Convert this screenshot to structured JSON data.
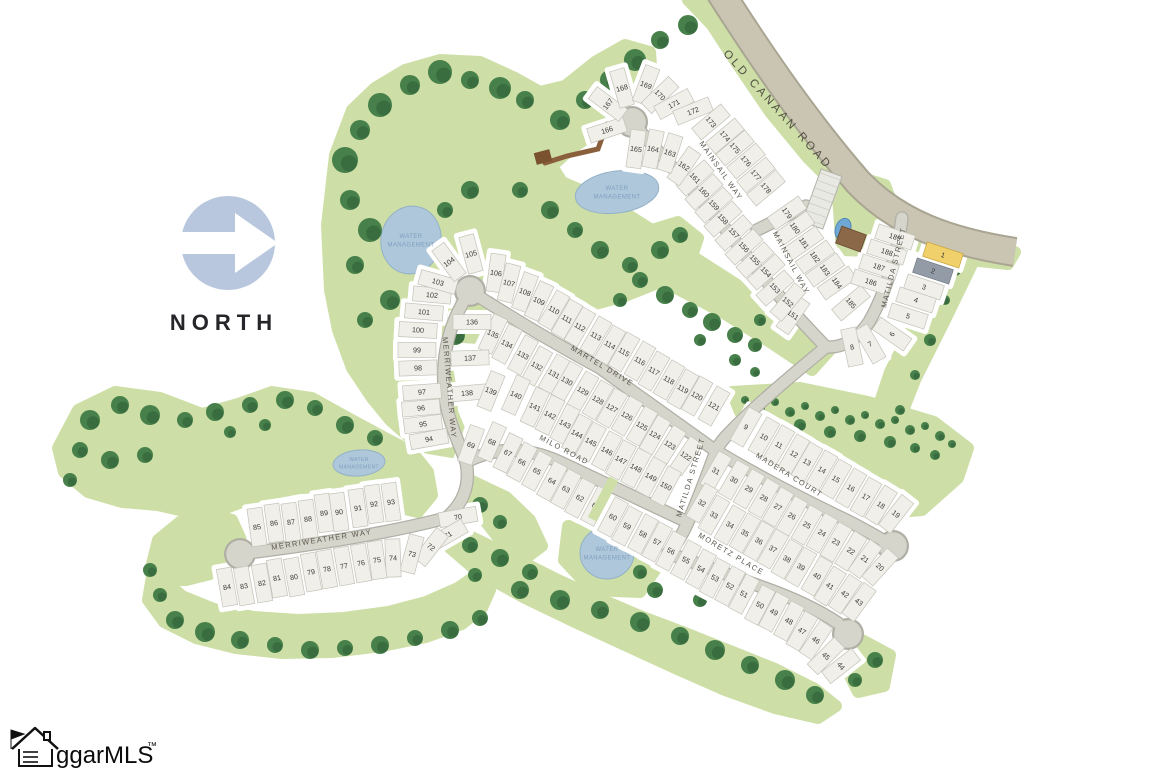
{
  "map": {
    "north_label": "NORTH",
    "logo": {
      "text": "ggarMLS",
      "tm": "™"
    },
    "water_label": [
      "WATER",
      "MANAGEMENT"
    ],
    "colors": {
      "green": "#cddfa6",
      "tree": "#47804a",
      "tree_dark": "#2e5c36",
      "road_fill": "#d6d5cc",
      "road_casing": "#b0afa6",
      "main_road_fill": "#c9c5b2",
      "main_road_casing": "#a9a592",
      "lot_fill": "#f0efe9",
      "lot_stroke": "#c3c3b9",
      "lot_number": "#3b3b37",
      "water_fill": "#afc7da",
      "water_stroke": "#93b1c7",
      "water_text": "#7e9fc0",
      "street_text": "#5a574e",
      "north_circle": "#b8c7dd"
    },
    "highlights": {
      "1": {
        "fill": "#f0d06a",
        "stroke": "#c7a43c"
      },
      "2": {
        "fill": "#939ba7",
        "stroke": "#737b87"
      }
    },
    "streets": [
      {
        "name": "OLD CANAAN ROAD",
        "x": 775,
        "y": 112,
        "rot": 48,
        "size": 11.5,
        "ls": 3,
        "color": "#514e44"
      },
      {
        "name": "MAINSAIL WAY",
        "x": 719,
        "y": 172,
        "rot": 55
      },
      {
        "name": "MAINSAIL WAY",
        "x": 789,
        "y": 264,
        "rot": 62
      },
      {
        "name": "MATILDA STREET",
        "x": 896,
        "y": 268,
        "rot": -76
      },
      {
        "name": "MATILDA STREET",
        "x": 693,
        "y": 478,
        "rot": -73
      },
      {
        "name": "MARTEL DRIVE",
        "x": 601,
        "y": 368,
        "rot": 31
      },
      {
        "name": "MERRIWEATHER WAY",
        "x": 447,
        "y": 388,
        "rot": 85
      },
      {
        "name": "MERRIWEATHER WAY",
        "x": 322,
        "y": 542,
        "rot": -9
      },
      {
        "name": "MILO ROAD",
        "x": 563,
        "y": 452,
        "rot": 28
      },
      {
        "name": "MADERA COURT",
        "x": 788,
        "y": 477,
        "rot": 32
      },
      {
        "name": "MORETZ PLACE",
        "x": 730,
        "y": 556,
        "rot": 31
      }
    ],
    "water_areas": [
      {
        "x": 617,
        "y": 192,
        "rx": 42,
        "ry": 21,
        "rot": -8,
        "label_size": 6
      },
      {
        "x": 411,
        "y": 240,
        "rx": 30,
        "ry": 34,
        "rot": 10,
        "label_size": 6
      },
      {
        "x": 359,
        "y": 463,
        "rx": 26,
        "ry": 13,
        "rot": -5,
        "label_size": 5
      },
      {
        "x": 607,
        "y": 553,
        "rx": 27,
        "ry": 26,
        "rot": 0,
        "label_size": 6
      }
    ],
    "lots": [
      [
        1,
        943,
        255,
        -72
      ],
      [
        2,
        933,
        271,
        -72
      ],
      [
        3,
        924,
        287,
        -72
      ],
      [
        4,
        916,
        300,
        -72
      ],
      [
        5,
        908,
        316,
        -72
      ],
      [
        6,
        892,
        334,
        -55
      ],
      [
        7,
        870,
        344,
        -30
      ],
      [
        8,
        852,
        347,
        -12
      ],
      [
        9,
        746,
        427,
        30
      ],
      [
        10,
        764,
        437,
        30
      ],
      [
        11,
        779,
        445,
        30
      ],
      [
        12,
        794,
        454,
        30
      ],
      [
        13,
        807,
        462,
        30
      ],
      [
        14,
        822,
        470,
        30
      ],
      [
        15,
        836,
        479,
        30
      ],
      [
        16,
        851,
        488,
        30
      ],
      [
        17,
        866,
        497,
        30
      ],
      [
        18,
        881,
        505,
        32
      ],
      [
        19,
        896,
        514,
        38
      ],
      [
        20,
        880,
        567,
        42
      ],
      [
        21,
        865,
        559,
        36
      ],
      [
        22,
        851,
        551,
        32
      ],
      [
        23,
        836,
        542,
        30
      ],
      [
        24,
        822,
        533,
        30
      ],
      [
        25,
        807,
        525,
        30
      ],
      [
        26,
        792,
        516,
        30
      ],
      [
        27,
        778,
        507,
        30
      ],
      [
        28,
        764,
        498,
        30
      ],
      [
        29,
        749,
        489,
        30
      ],
      [
        30,
        734,
        480,
        30
      ],
      [
        31,
        716,
        471,
        30
      ],
      [
        32,
        702,
        503,
        30
      ],
      [
        33,
        714,
        515,
        30
      ],
      [
        34,
        730,
        525,
        30
      ],
      [
        35,
        745,
        533,
        30
      ],
      [
        36,
        759,
        541,
        30
      ],
      [
        37,
        773,
        549,
        30
      ],
      [
        38,
        787,
        559,
        30
      ],
      [
        39,
        801,
        567,
        30
      ],
      [
        40,
        817,
        576,
        30
      ],
      [
        41,
        830,
        586,
        32
      ],
      [
        42,
        845,
        594,
        34
      ],
      [
        43,
        859,
        602,
        36
      ],
      [
        44,
        841,
        666,
        52
      ],
      [
        45,
        826,
        656,
        45
      ],
      [
        46,
        816,
        640,
        34
      ],
      [
        47,
        802,
        631,
        30
      ],
      [
        48,
        789,
        621,
        28
      ],
      [
        49,
        774,
        612,
        28
      ],
      [
        50,
        760,
        605,
        28
      ],
      [
        51,
        744,
        594,
        28
      ],
      [
        52,
        730,
        586,
        28
      ],
      [
        53,
        715,
        578,
        28
      ],
      [
        54,
        701,
        569,
        28
      ],
      [
        55,
        686,
        560,
        28
      ],
      [
        56,
        671,
        551,
        28
      ],
      [
        57,
        657,
        542,
        28
      ],
      [
        58,
        643,
        534,
        28
      ],
      [
        59,
        627,
        526,
        28
      ],
      [
        60,
        613,
        517,
        28
      ],
      [
        61,
        596,
        506,
        28
      ],
      [
        62,
        580,
        498,
        28
      ],
      [
        63,
        566,
        489,
        28
      ],
      [
        64,
        552,
        481,
        28
      ],
      [
        65,
        537,
        471,
        28
      ],
      [
        66,
        522,
        462,
        28
      ],
      [
        67,
        508,
        453,
        26
      ],
      [
        68,
        492,
        442,
        24
      ],
      [
        69,
        471,
        445,
        20
      ],
      [
        70,
        458,
        517,
        80
      ],
      [
        71,
        448,
        535,
        60
      ],
      [
        72,
        431,
        547,
        38
      ],
      [
        73,
        412,
        554,
        15
      ],
      [
        74,
        393,
        558,
        -2
      ],
      [
        75,
        377,
        560,
        -8
      ],
      [
        76,
        361,
        563,
        -10
      ],
      [
        77,
        344,
        566,
        -10
      ],
      [
        78,
        327,
        569,
        -10
      ],
      [
        79,
        311,
        572,
        -10
      ],
      [
        80,
        294,
        577,
        -10
      ],
      [
        81,
        277,
        578,
        -10
      ],
      [
        82,
        262,
        583,
        -10
      ],
      [
        83,
        244,
        586,
        -10
      ],
      [
        84,
        227,
        587,
        -10
      ],
      [
        85,
        257,
        527,
        -8
      ],
      [
        86,
        274,
        523,
        -8
      ],
      [
        87,
        291,
        522,
        -8
      ],
      [
        88,
        308,
        519,
        -8
      ],
      [
        89,
        324,
        513,
        -8
      ],
      [
        90,
        339,
        512,
        -8
      ],
      [
        91,
        358,
        508,
        -8
      ],
      [
        92,
        374,
        504,
        -8
      ],
      [
        93,
        391,
        502,
        -8
      ],
      [
        94,
        429,
        439,
        80
      ],
      [
        95,
        423,
        424,
        83
      ],
      [
        96,
        421,
        408,
        85
      ],
      [
        97,
        422,
        392,
        86
      ],
      [
        98,
        418,
        368,
        88
      ],
      [
        99,
        417,
        350,
        90
      ],
      [
        100,
        418,
        330,
        -87
      ],
      [
        101,
        424,
        312,
        -85
      ],
      [
        102,
        432,
        295,
        -85
      ],
      [
        103,
        438,
        282,
        -74
      ],
      [
        104,
        449,
        262,
        -36
      ],
      [
        105,
        471,
        254,
        -15
      ],
      [
        106,
        496,
        273,
        8
      ],
      [
        107,
        509,
        283,
        14
      ],
      [
        108,
        525,
        292,
        20
      ],
      [
        109,
        539,
        301,
        25
      ],
      [
        110,
        554,
        310,
        30
      ],
      [
        111,
        567,
        319,
        30
      ],
      [
        112,
        580,
        327,
        30
      ],
      [
        113,
        596,
        336,
        30
      ],
      [
        114,
        610,
        345,
        30
      ],
      [
        115,
        624,
        352,
        30
      ],
      [
        116,
        640,
        361,
        30
      ],
      [
        117,
        654,
        371,
        30
      ],
      [
        118,
        669,
        380,
        30
      ],
      [
        119,
        683,
        389,
        30
      ],
      [
        120,
        697,
        396,
        30
      ],
      [
        121,
        714,
        406,
        30
      ],
      [
        122,
        686,
        456,
        34
      ],
      [
        123,
        670,
        445,
        32
      ],
      [
        124,
        655,
        435,
        30
      ],
      [
        125,
        642,
        426,
        30
      ],
      [
        126,
        627,
        416,
        30
      ],
      [
        127,
        612,
        408,
        30
      ],
      [
        128,
        598,
        400,
        30
      ],
      [
        129,
        583,
        391,
        30
      ],
      [
        130,
        567,
        381,
        30
      ],
      [
        131,
        554,
        374,
        30
      ],
      [
        132,
        537,
        366,
        29
      ],
      [
        133,
        523,
        355,
        28
      ],
      [
        134,
        507,
        344,
        27
      ],
      [
        135,
        493,
        334,
        25
      ],
      [
        136,
        472,
        322,
        90
      ],
      [
        137,
        470,
        358,
        88
      ],
      [
        138,
        467,
        393,
        85
      ],
      [
        139,
        491,
        391,
        22
      ],
      [
        140,
        516,
        395,
        24
      ],
      [
        141,
        535,
        407,
        25
      ],
      [
        142,
        550,
        415,
        26
      ],
      [
        143,
        565,
        424,
        27
      ],
      [
        144,
        577,
        434,
        28
      ],
      [
        145,
        591,
        442,
        28
      ],
      [
        146,
        607,
        451,
        28
      ],
      [
        147,
        621,
        460,
        28
      ],
      [
        148,
        636,
        468,
        28
      ],
      [
        149,
        651,
        477,
        28
      ],
      [
        150,
        666,
        486,
        28
      ],
      [
        151,
        793,
        315,
        35
      ],
      [
        152,
        788,
        302,
        40
      ],
      [
        153,
        775,
        288,
        48
      ],
      [
        154,
        766,
        272,
        48
      ],
      [
        155,
        755,
        260,
        48
      ],
      [
        156,
        744,
        247,
        48
      ],
      [
        157,
        734,
        233,
        48
      ],
      [
        158,
        723,
        219,
        48
      ],
      [
        159,
        714,
        205,
        48
      ],
      [
        160,
        704,
        192,
        48
      ],
      [
        161,
        695,
        178,
        48
      ],
      [
        162,
        684,
        166,
        35
      ],
      [
        163,
        670,
        153,
        18
      ],
      [
        164,
        653,
        149,
        12
      ],
      [
        165,
        636,
        149,
        8
      ],
      [
        166,
        607,
        130,
        72
      ],
      [
        167,
        608,
        104,
        -53
      ],
      [
        168,
        622,
        88,
        -16
      ],
      [
        169,
        646,
        85,
        21
      ],
      [
        170,
        660,
        95,
        46
      ],
      [
        171,
        674,
        104,
        62
      ],
      [
        172,
        693,
        111,
        68
      ],
      [
        173,
        711,
        122,
        50
      ],
      [
        174,
        725,
        136,
        50
      ],
      [
        175,
        735,
        148,
        50
      ],
      [
        176,
        746,
        161,
        50
      ],
      [
        177,
        756,
        175,
        50
      ],
      [
        178,
        766,
        188,
        50
      ],
      [
        179,
        787,
        213,
        55
      ],
      [
        180,
        795,
        228,
        55
      ],
      [
        181,
        804,
        243,
        55
      ],
      [
        182,
        815,
        257,
        55
      ],
      [
        183,
        825,
        270,
        55
      ],
      [
        184,
        837,
        283,
        55
      ],
      [
        185,
        851,
        303,
        50
      ],
      [
        186,
        871,
        282,
        -72
      ],
      [
        187,
        879,
        267,
        -72
      ],
      [
        188,
        887,
        252,
        -72
      ],
      [
        189,
        895,
        237,
        -72
      ]
    ]
  }
}
